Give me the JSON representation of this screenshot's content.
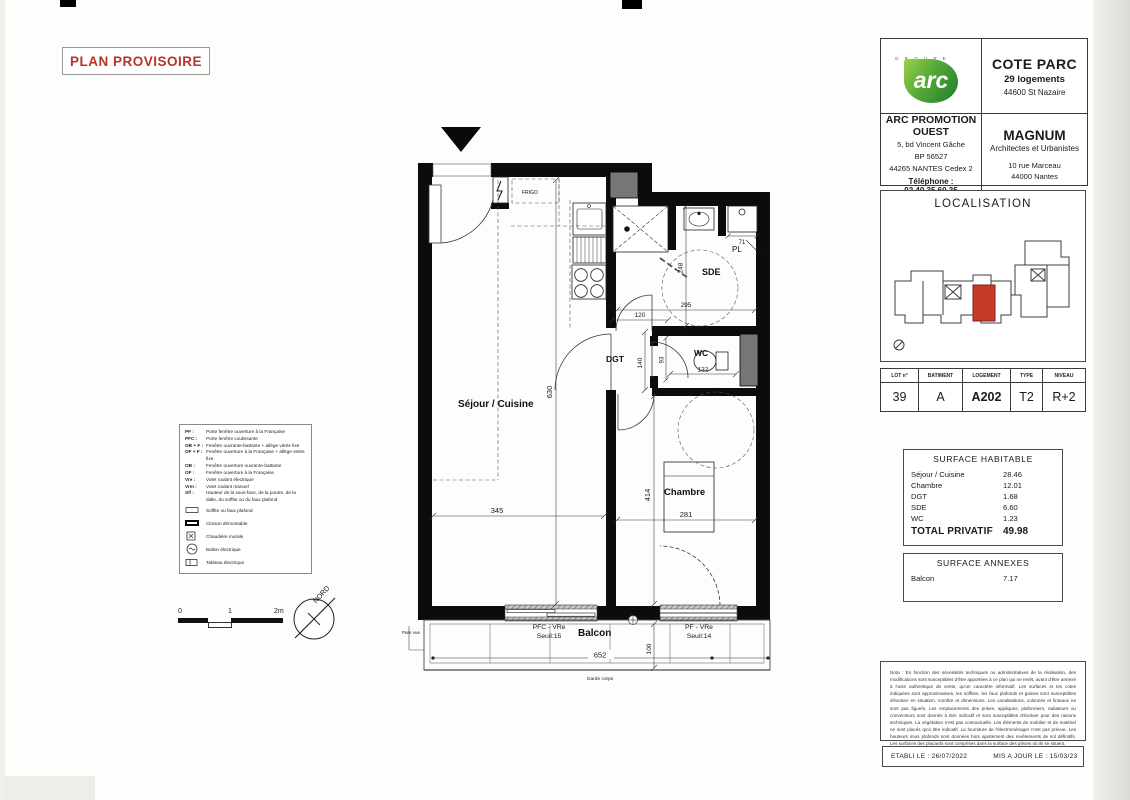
{
  "page": {
    "stamp": "PLAN PROVISOIRE"
  },
  "title_block": {
    "group_label": "G R O U P E",
    "logo_text": "arc",
    "project": {
      "name": "COTE PARC",
      "units": "29 logements",
      "city": "44600 St Nazaire"
    },
    "promoter": {
      "name": "ARC PROMOTION OUEST",
      "address1": "5, bd Vincent Gâche",
      "address2": "BP 56527",
      "address3": "44265 NANTES Cedex 2",
      "phone": "Téléphone : 02.40.35.60.35"
    },
    "architect": {
      "name": "MAGNUM",
      "subtitle": "Architectes et Urbanistes",
      "address1": "10 rue Marceau",
      "address2": "44000 Nantes"
    },
    "localisation_title": "LOCALISATION",
    "lot_table": {
      "headers": [
        "LOT n°",
        "BATIMENT",
        "LOGEMENT",
        "TYPE",
        "NIVEAU"
      ],
      "values": [
        "39",
        "A",
        "A202",
        "T2",
        "R+2"
      ]
    },
    "surface_habitable": {
      "title": "SURFACE HABITABLE",
      "rows": [
        {
          "label": "Séjour / Cuisine",
          "value": "28.46"
        },
        {
          "label": "Chambre",
          "value": "12.01"
        },
        {
          "label": "DGT",
          "value": "1.68"
        },
        {
          "label": "SDE",
          "value": "6.60"
        },
        {
          "label": "WC",
          "value": "1.23"
        }
      ],
      "total_label": "TOTAL PRIVATIF",
      "total_value": "49.98"
    },
    "surface_annexes": {
      "title": "SURFACE ANNEXES",
      "rows": [
        {
          "label": "Balcon",
          "value": "7.17"
        }
      ]
    },
    "nota": "Nota : En fonction des nécessités techniques ou administratives de la réalisation, des modifications sont susceptibles d'être apportées à ce plan qui ne revêt, avant d'être annexé à l'acte authentique de vente, qu'un caractère informatif. Les surfaces et les cotes indiquées sont approximatives, les soffites, les faux plafonds et gaines sont susceptibles d'évoluer en situation, nombre et dimensions. Les canalisations, colonnes et linteaux ne sont pas figurés. Les emplacements des prises, appliques, plafonniers, radiateurs ou convecteurs sont donnés à titre indicatif et sont susceptibles d'évoluer pour des raisons techniques. La végétation n'est pas contractuelle. Les éléments de mobilier et de matériel ne sont placés qu'à titre indicatif. La fourniture de l'électroménager n'est pas prévue. Les hauteurs sous plafonds sont données hors ajustement des revêtements de sol définitifs. Les surfaces des placards sont comprises dans la surface des pièces où ils se situent.",
    "established": "ETABLI LE : 26/07/2022",
    "updated": "MIS A JOUR LE : 15/03/23"
  },
  "legend": {
    "lines": [
      {
        "abbr": "PF :",
        "text": "Porte fenêtre ouverture à la Française"
      },
      {
        "abbr": "PFC :",
        "text": "Porte fenêtre coulissante"
      },
      {
        "abbr": "OB + F :",
        "text": "Fenêtre ouvrante-battante + allège vitrée fixe"
      },
      {
        "abbr": "OF + F :",
        "text": "Fenêtre ouverture à la Française + allège vitrée fixe"
      },
      {
        "abbr": "OB :",
        "text": "Fenêtre ouverture ouvrante-battante"
      },
      {
        "abbr": "OF :",
        "text": "Fenêtre ouverture à la Française"
      },
      {
        "abbr": "Vre :",
        "text": "Volet roulant électrique"
      },
      {
        "abbr": "Vrm :",
        "text": "Volet roulant manuel"
      },
      {
        "abbr": "S/f :",
        "text": "Hauteur de la sous-face, de la poutre, de la dalle, du soffite ou du faux plafond"
      }
    ],
    "symbols": [
      {
        "text": "Soffite ou faux plafond"
      },
      {
        "text": "Cloison démontable"
      },
      {
        "text": "Chaudière murale"
      },
      {
        "text": "Ballon électrique"
      },
      {
        "text": "Tableau électrique"
      }
    ]
  },
  "scalebar": {
    "t0": "0",
    "t1": "1",
    "t2": "2m"
  },
  "compass": {
    "label": "NORD"
  },
  "plan": {
    "rooms": {
      "sejour": "Séjour / Cuisine",
      "chambre": "Chambre",
      "sde": "SDE",
      "wc": "WC",
      "dgt": "DGT",
      "balcon": "Balcon",
      "pl": "PL",
      "frigo": "FRIGO"
    },
    "dims": {
      "d630": "630",
      "d345": "345",
      "d414": "414",
      "d281": "281",
      "d248": "248",
      "d295": "295",
      "d120": "120",
      "d140": "140",
      "d93": "93",
      "d132": "132",
      "d71": "71",
      "d100": "100",
      "d652": "652"
    },
    "windows": {
      "w1_type": "PFC - VRe",
      "w1_seuil": "Seuil:15",
      "w2_type": "PF - VRe",
      "w2_seuil": "Seuil:14"
    },
    "notes": {
      "pare_vue": "Pare vue",
      "garde_corps": "Garde corps"
    }
  }
}
